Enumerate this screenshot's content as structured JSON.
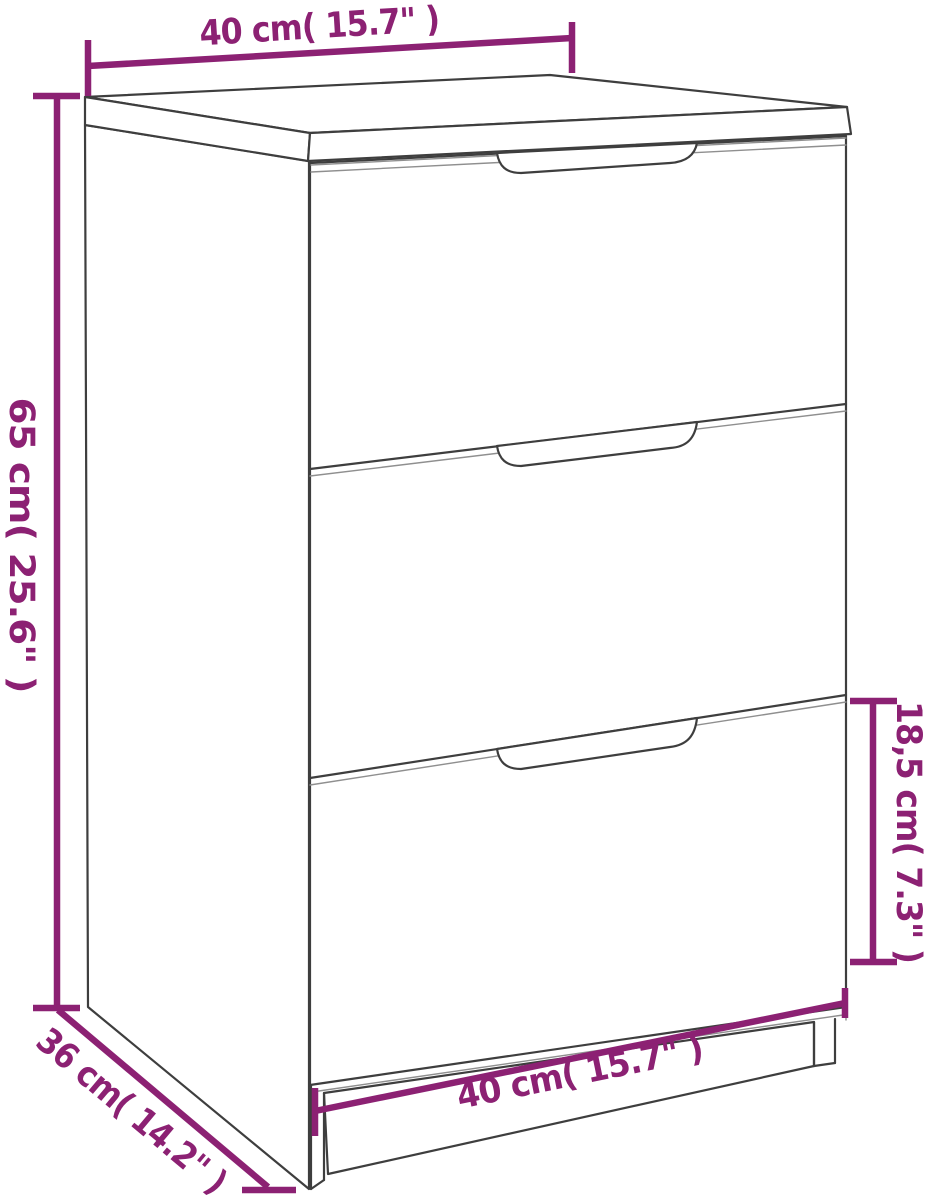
{
  "page": {
    "background_color": "#ffffff"
  },
  "diagram": {
    "subject": "bedside-cabinet-with-3-drawers",
    "accent_color": "#8C2173",
    "outline_color": "#3E3E3E",
    "dimensions": {
      "top_width": {
        "label": "40 cm( 15.7\" )",
        "placement": "above cabinet top"
      },
      "height": {
        "label": "65 cm( 25.6\" )",
        "placement": "left of cabinet"
      },
      "depth": {
        "label": "36 cm( 14.2\" )",
        "placement": "bottom-left diagonal"
      },
      "drawer_height": {
        "label": "18,5 cm( 7.3\" )",
        "placement": "right of bottom drawer"
      },
      "bottom_width": {
        "label": "40 cm( 15.7\" )",
        "placement": "along cabinet base"
      }
    }
  }
}
